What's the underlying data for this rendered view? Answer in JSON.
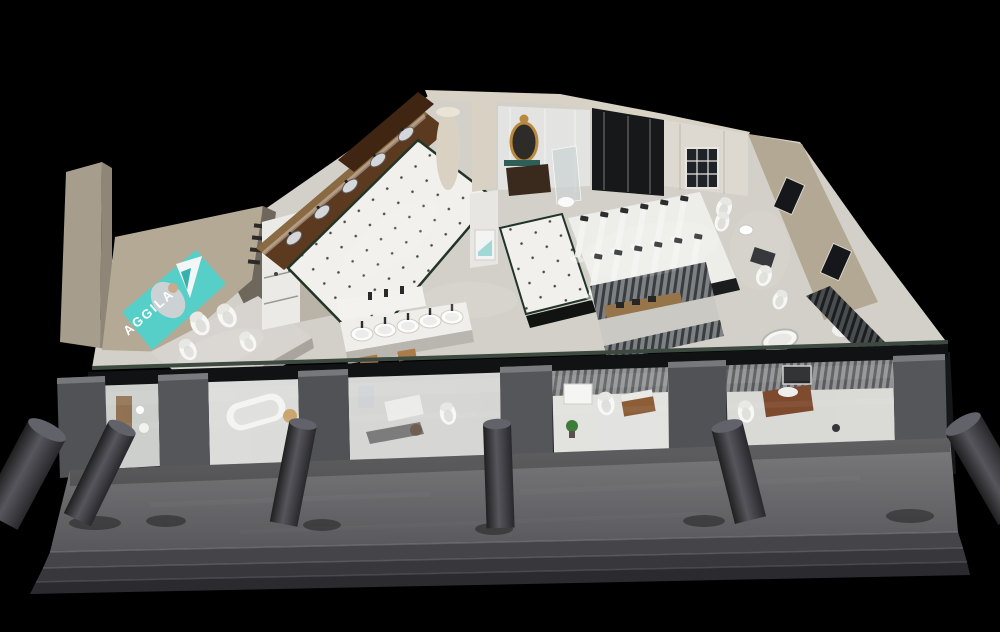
{
  "sign": {
    "brand_text": "AGGILA"
  },
  "colors": {
    "background": "#000000",
    "brand_teal": "#57cfc9",
    "gold_frame": "#b9893f",
    "walkway_gray": "#6a6a6e",
    "step_gray": "#3a3a3e",
    "pillar_gray": "#46464c",
    "floor_light": "#d3d0c9",
    "tile_white": "#f1f0ec",
    "wall_beige": "#b3a995",
    "wall_white": "#e7e5e0",
    "wood_dark": "#5c3a1f",
    "wood_warm": "#8a5a33",
    "glass_frame_black": "#101214",
    "slat_gray": "#7e8184",
    "plant_green": "#3c7a38"
  },
  "counts": {
    "front_pillars": 6,
    "storefront_piers": 6,
    "front_display_rooms": 5,
    "countertop_basins": 5,
    "shower_panels": 12,
    "left_display_toilets": 4,
    "counter_sinks": 5,
    "front_steps": 3
  }
}
